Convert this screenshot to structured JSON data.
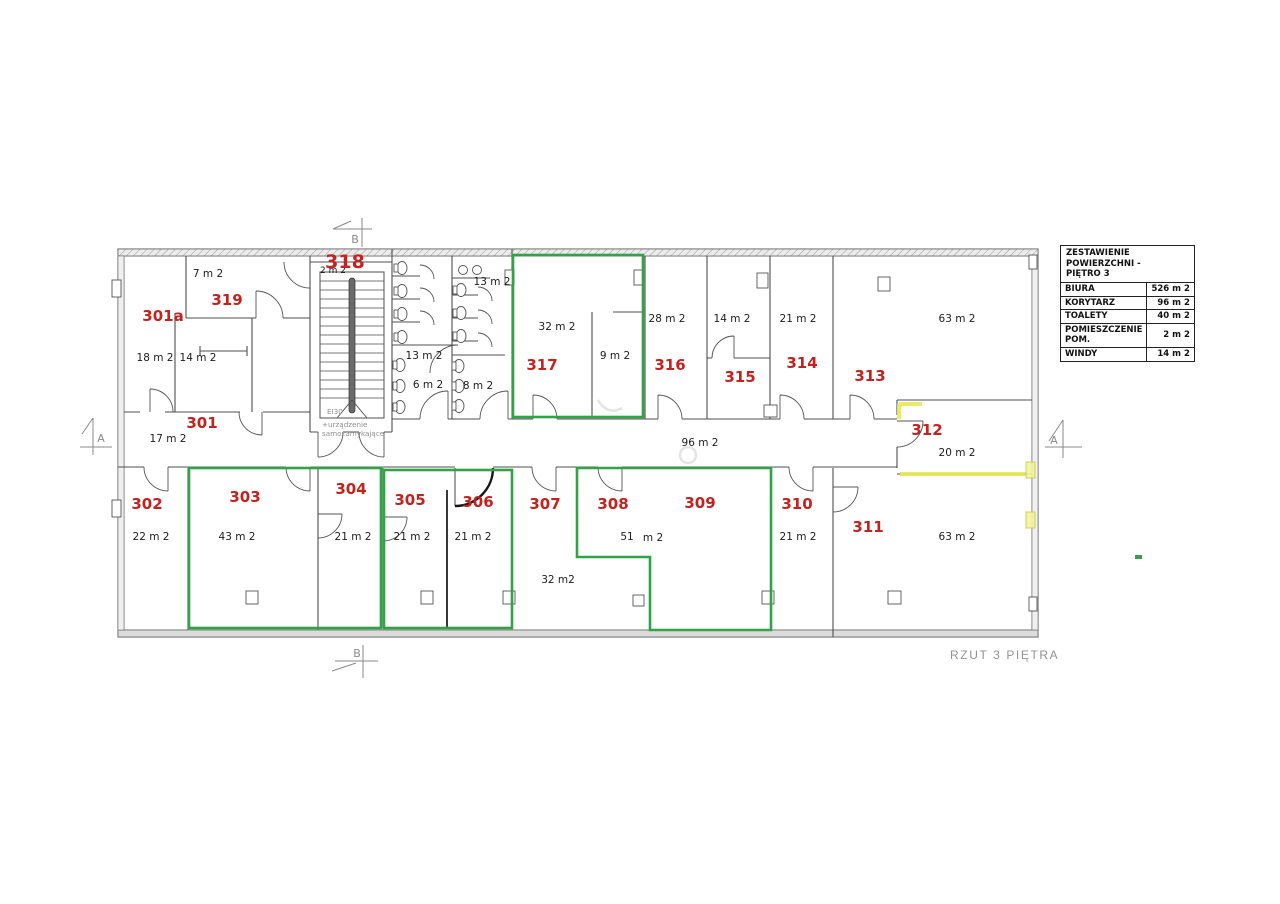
{
  "drawing_title": "RZUT 3 PIĘTRA",
  "legend": {
    "title_line1": "ZESTAWIENIE POWIERZCHNI -",
    "title_line2": "PIĘTRO 3",
    "rows": [
      {
        "label": "BIURA",
        "value": "526 m 2"
      },
      {
        "label": "KORYTARZ",
        "value": "96 m 2"
      },
      {
        "label": "TOALETY",
        "value": "40 m 2"
      },
      {
        "label": "POMIESZCZENIE POM.",
        "value": "2 m 2"
      },
      {
        "label": "WINDY",
        "value": "14 m 2"
      }
    ]
  },
  "rooms": {
    "r301": {
      "number": "301",
      "area": "17 m 2"
    },
    "r301a": {
      "number": "301a",
      "area_left": "18 m 2",
      "area_right": "14 m 2"
    },
    "r302": {
      "number": "302",
      "area": "22 m 2"
    },
    "r303": {
      "number": "303",
      "area": "43 m 2"
    },
    "r304": {
      "number": "304",
      "area": "21 m 2"
    },
    "r305": {
      "number": "305",
      "area": "21 m 2"
    },
    "r306": {
      "number": "306",
      "area": "21 m 2"
    },
    "r307": {
      "number": "307",
      "area": "32 m2"
    },
    "r308": {
      "number": "308",
      "area_value": "51",
      "area_unit": "m 2"
    },
    "r309": {
      "number": "309"
    },
    "r310": {
      "number": "310",
      "area": "21 m 2"
    },
    "r311": {
      "number": "311",
      "area": "63 m 2"
    },
    "r312": {
      "number": "312",
      "area": "20 m 2"
    },
    "r313": {
      "number": "313",
      "area": "63 m 2"
    },
    "r314": {
      "number": "314",
      "area": "21 m 2"
    },
    "r315": {
      "number": "315",
      "area": "14 m 2"
    },
    "r316": {
      "number": "316",
      "area": "28 m 2"
    },
    "r317": {
      "number": "317",
      "area_main": "32 m 2",
      "area_sub": "9 m 2"
    },
    "r318": {
      "number": "318",
      "area": "2 m 2"
    },
    "r319": {
      "number": "319",
      "area": "7 m 2"
    }
  },
  "corridor": {
    "area": "96 m 2"
  },
  "toilets": {
    "top_left": "13 m 2",
    "bottom_left": "6 m 2",
    "top_right": "13 m 2",
    "bottom_right": "8 m 2"
  },
  "stairwell": {
    "fire_rating": "EI30",
    "note_line1": "+urządzenie",
    "note_line2": "samozamykające"
  },
  "section_markers": {
    "a": "A",
    "b": "B"
  },
  "colors": {
    "room_label_red": "#c5221f",
    "highlight_green": "#31a248",
    "highlight_yellow": "#e8e855",
    "wall_gray": "#4f4f4f",
    "muted_gray": "#8f8f8f"
  }
}
